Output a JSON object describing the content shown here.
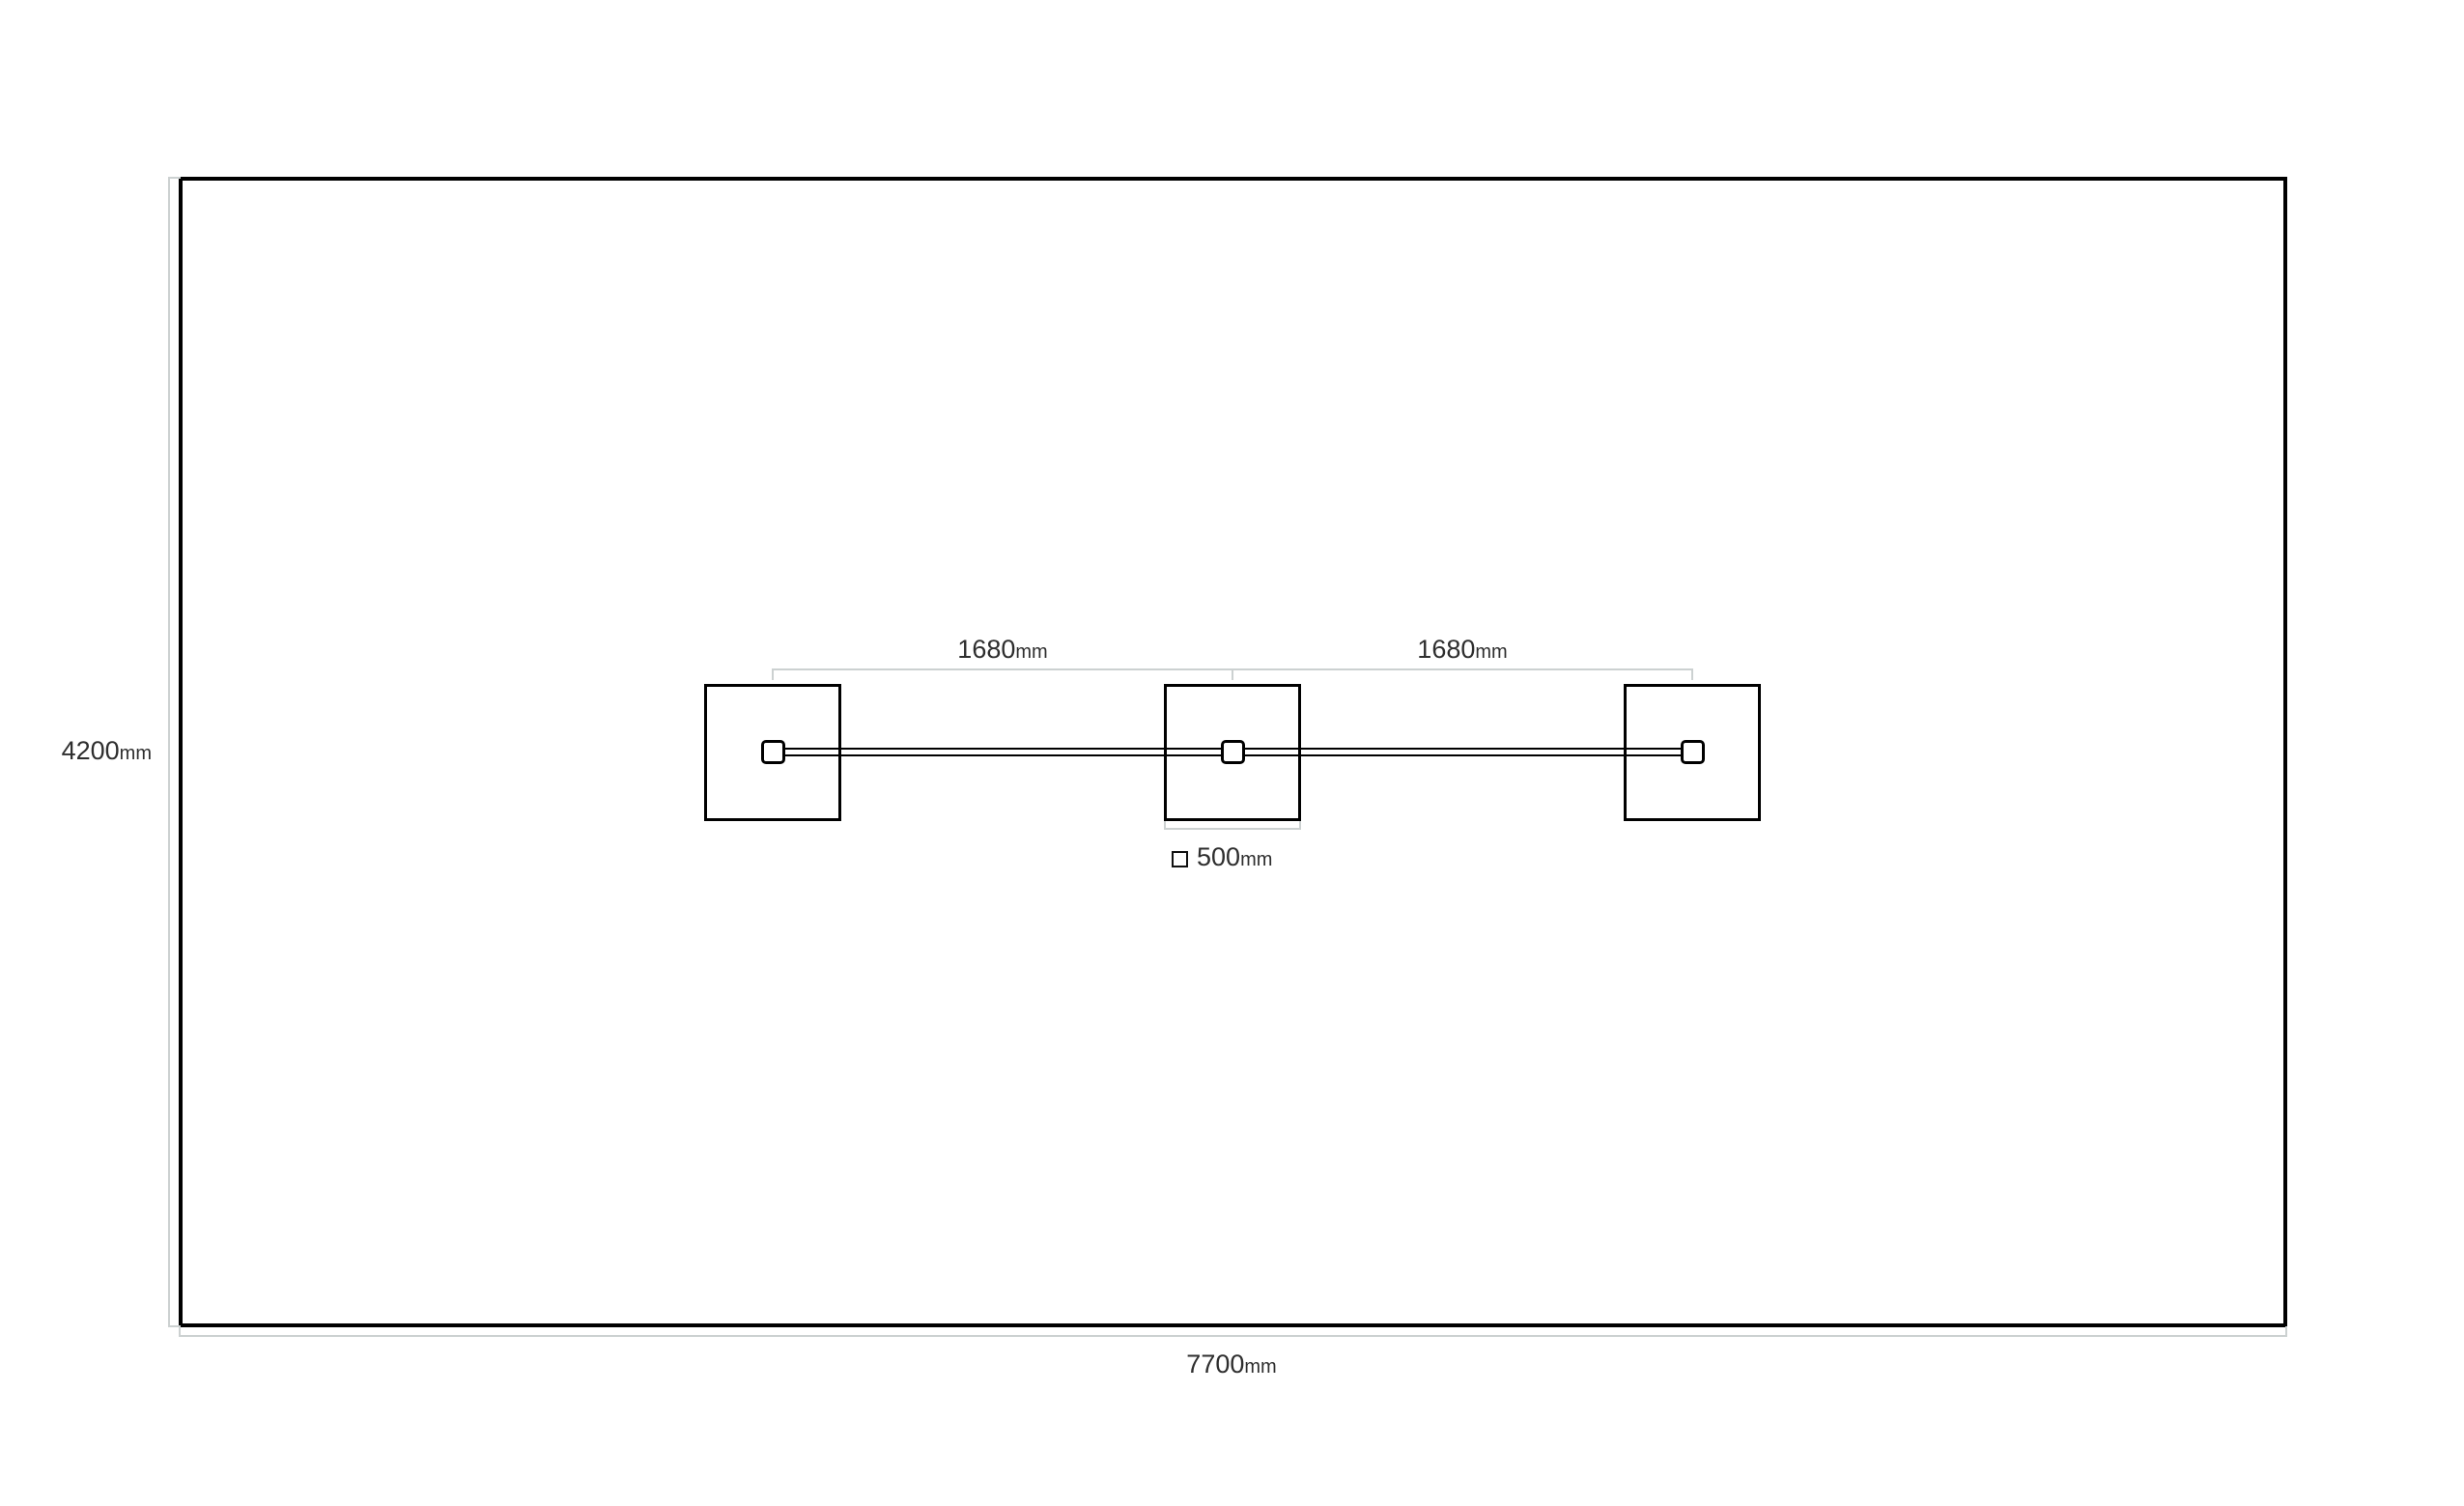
{
  "colors": {
    "background": "#ffffff",
    "outline": "#000000",
    "dimension_line": "#ccd1d1",
    "label_text": "#2e2e2e"
  },
  "labels": {
    "room_height": {
      "value": "4200",
      "unit": "mm"
    },
    "room_width": {
      "value": "7700",
      "unit": "mm"
    },
    "gap_left": {
      "value": "1680",
      "unit": "mm"
    },
    "gap_right": {
      "value": "1680",
      "unit": "mm"
    },
    "legend_size": {
      "value": "500",
      "unit": "mm"
    }
  },
  "fixtures": {
    "count": 3
  }
}
